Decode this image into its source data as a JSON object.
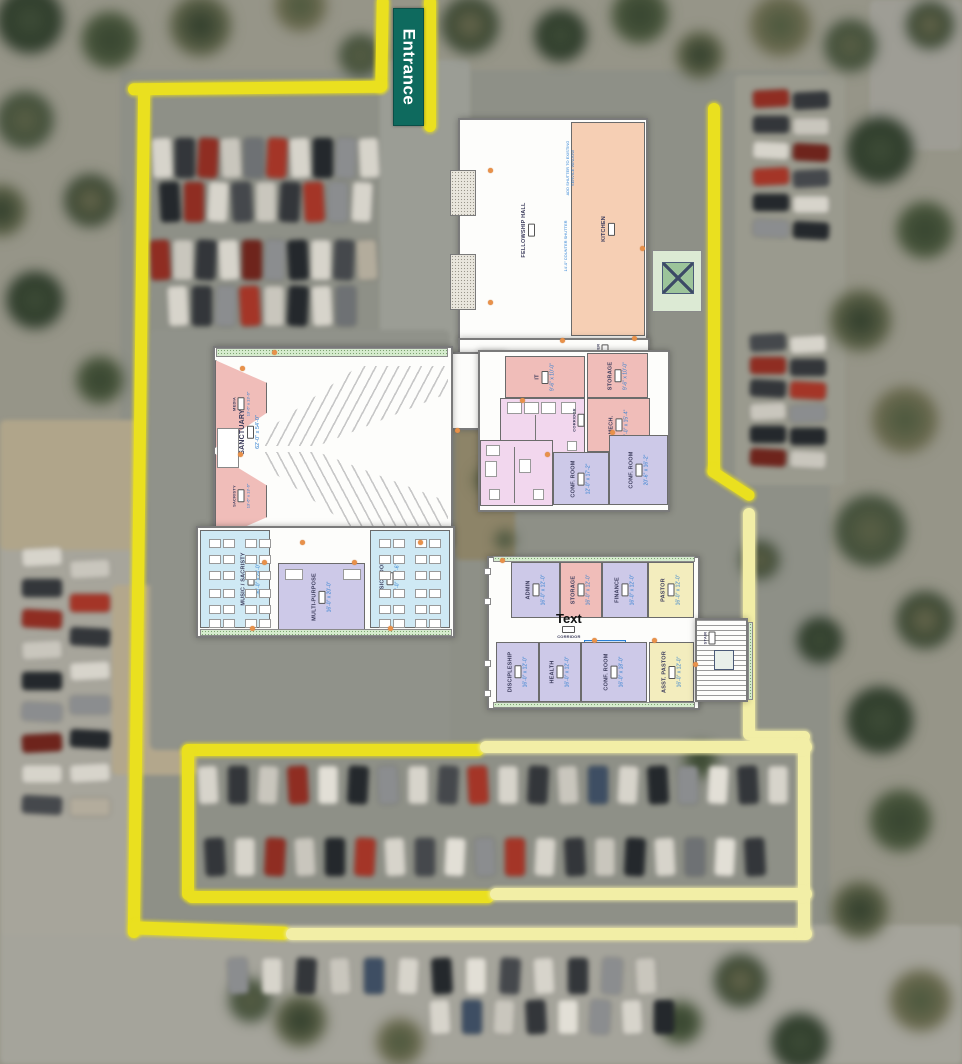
{
  "site": {
    "entrance": {
      "label": "Entrance"
    }
  },
  "colors": {
    "boundary_bright": "#eae01f",
    "boundary_pale": "#f2eea6",
    "entrance_sign_bg": "#0e6a5e",
    "room_pink": "#f0bdb9",
    "room_peach": "#f6cfb4",
    "room_lavender": "#cdc9e8",
    "room_light_blue": "#cfe9f4",
    "room_pale_yellow": "#f3edbe",
    "room_restroom": "#f2d7ee",
    "porch_hatch_green": "#d6ecce",
    "dims_text_blue": "#2f7fd0"
  },
  "plan": {
    "annotations": {
      "shutter": "ADD SHUTTER TO EXISTING SERVICE WINDOW",
      "counter_shutter": "14'-0\" COUNTER SHUTTER",
      "text_artifact": "Text",
      "corridor": "CORRIDOR",
      "corridor2": "CORRIDOR",
      "foyer": "FOYER",
      "stair": "STAIR"
    },
    "rooms": {
      "fellowship_hall": {
        "label": "FELLOWSHIP HALL"
      },
      "kitchen": {
        "label": "KITCHEN"
      },
      "sanctuary": {
        "label": "SANCTUARY",
        "dims": "62'-0\" x 54'-0\""
      },
      "media": {
        "label": "MEDIA",
        "dims": "13'-6\" x 13'-6\""
      },
      "sacristy": {
        "label": "SACRISTY",
        "dims": "13'-6\" x 13'-6\""
      },
      "music_sacristy": {
        "label": "MUSIC / SACRISTY",
        "dims": "30'-0\" x 24'-0\""
      },
      "multipurpose": {
        "label": "MULTI-PURPOSE",
        "dims": "16'-0\" x 20'-0\""
      },
      "music_room": {
        "label": "MUSIC ROOM",
        "dims": "30'-0\" x 19'-6\""
      },
      "it": {
        "label": "IT",
        "dims": "9'-6\" x 10'-0\""
      },
      "storage_north": {
        "label": "STORAGE",
        "dims": "9'-6\" x 10'-0\""
      },
      "mech": {
        "label": "MECH.",
        "dims": "10'-0\" x 15'-4\""
      },
      "conf_room_a": {
        "label": "CONF. ROOM",
        "dims": "12'-0\" x 17'-2\""
      },
      "conf_room_b": {
        "label": "CONF. ROOM",
        "dims": "20'-6\" x 16'-2\""
      },
      "admin": {
        "label": "ADMIN",
        "dims": "16'-0\" x 12'-0\""
      },
      "storage_south": {
        "label": "STORAGE",
        "dims": "16'-0\" x 12'-0\""
      },
      "finance": {
        "label": "FINANCE",
        "dims": "16'-0\" x 12'-0\""
      },
      "pastor": {
        "label": "PASTOR",
        "dims": "16'-0\" x 12'-0\""
      },
      "discipleship": {
        "label": "DISCIPLESHIP",
        "dims": "16'-0\" x 12'-0\""
      },
      "health": {
        "label": "HEALTH",
        "dims": "16'-0\" x 12'-0\""
      },
      "conf_room_c": {
        "label": "CONF. ROOM",
        "dims": "16'-0\" x 18'-0\""
      },
      "asst_pastor": {
        "label": "ASST. PASTOR",
        "dims": "16'-0\" x 12'-0\""
      }
    }
  },
  "parking": {
    "nw_rows": [
      [
        "#d7d4cb",
        "#33363a",
        "#8f2d22",
        "#c9c6bd",
        "#6e7174",
        "#a43527",
        "#d7d4cb",
        "#24282c",
        "#8b8d8f",
        "#d7d4cb"
      ],
      [
        "#24282c",
        "#8f2d22",
        "#d7d4cb",
        "#45484c",
        "#c9c6bd",
        "#33363a",
        "#a43527",
        "#8b8d8f",
        "#d7d4cb"
      ],
      [
        "#8f2d22",
        "#c9c6bd",
        "#33363a",
        "#d7d4cb",
        "#6e241c",
        "#8b8d8f",
        "#24282c",
        "#d7d4cb",
        "#45484c",
        "#b3ac9c"
      ],
      [
        "#d7d4cb",
        "#33363a",
        "#8b8d8f",
        "#a43527",
        "#c9c6bd",
        "#24282c",
        "#d7d4cb",
        "#6e7174"
      ]
    ],
    "left_col_a": [
      "#d7d4cb",
      "#33363a",
      "#8f2d22",
      "#c9c6bd",
      "#24282c",
      "#8b8d8f",
      "#6e241c",
      "#d7d4cb",
      "#45484c"
    ],
    "left_col_b": [
      "#c9c6bd",
      "#a43527",
      "#33363a",
      "#d7d4cb",
      "#8b8d8f",
      "#24282c",
      "#d7d4cb",
      "#b3ac9c"
    ],
    "right_top_a": [
      "#8f2d22",
      "#33363a",
      "#d7d4cb",
      "#a43527",
      "#24282c",
      "#8b8d8f"
    ],
    "right_top_b": [
      "#33363a",
      "#c9c6bd",
      "#6e241c",
      "#45484c",
      "#d7d4cb",
      "#24282c"
    ],
    "right_mid_a": [
      "#45484c",
      "#8f2d22",
      "#33363a",
      "#c9c6bd",
      "#24282c",
      "#6e241c"
    ],
    "right_mid_b": [
      "#d7d4cb",
      "#33363a",
      "#a43527",
      "#8b8d8f",
      "#24282c",
      "#c9c6bd"
    ],
    "bottom_row1": [
      "#d7d4cb",
      "#33363a",
      "#c9c6bd",
      "#8f2d22",
      "#e2dfd6",
      "#24282c",
      "#8b8d8f",
      "#d7d4cb",
      "#45484c",
      "#a43527",
      "#d7d4cb",
      "#33363a",
      "#c9c6bd",
      "#3e4e63",
      "#d7d4cb",
      "#24282c",
      "#8b8d8f",
      "#e2dfd6",
      "#33363a",
      "#d7d4cb"
    ],
    "bottom_row2": [
      "#33363a",
      "#d7d4cb",
      "#8f2d22",
      "#c9c6bd",
      "#24282c",
      "#a43527",
      "#d7d4cb",
      "#45484c",
      "#e2dfd6",
      "#8b8d8f",
      "#a43527",
      "#d7d4cb",
      "#33363a",
      "#c9c6bd",
      "#24282c",
      "#d7d4cb",
      "#6e7174",
      "#e2dfd6",
      "#33363a"
    ],
    "south_row": [
      "#8b8d8f",
      "#d7d4cb",
      "#33363a",
      "#c9c6bd",
      "#3e4e63",
      "#d7d4cb",
      "#24282c",
      "#e2dfd6",
      "#45484c",
      "#d7d4cb",
      "#33363a",
      "#8b8d8f",
      "#c9c6bd"
    ],
    "south_cluster": [
      "#d7d4cb",
      "#3e4e63",
      "#c9c6bd",
      "#33363a",
      "#e2dfd6",
      "#8b8d8f",
      "#d7d4cb",
      "#24282c"
    ]
  }
}
